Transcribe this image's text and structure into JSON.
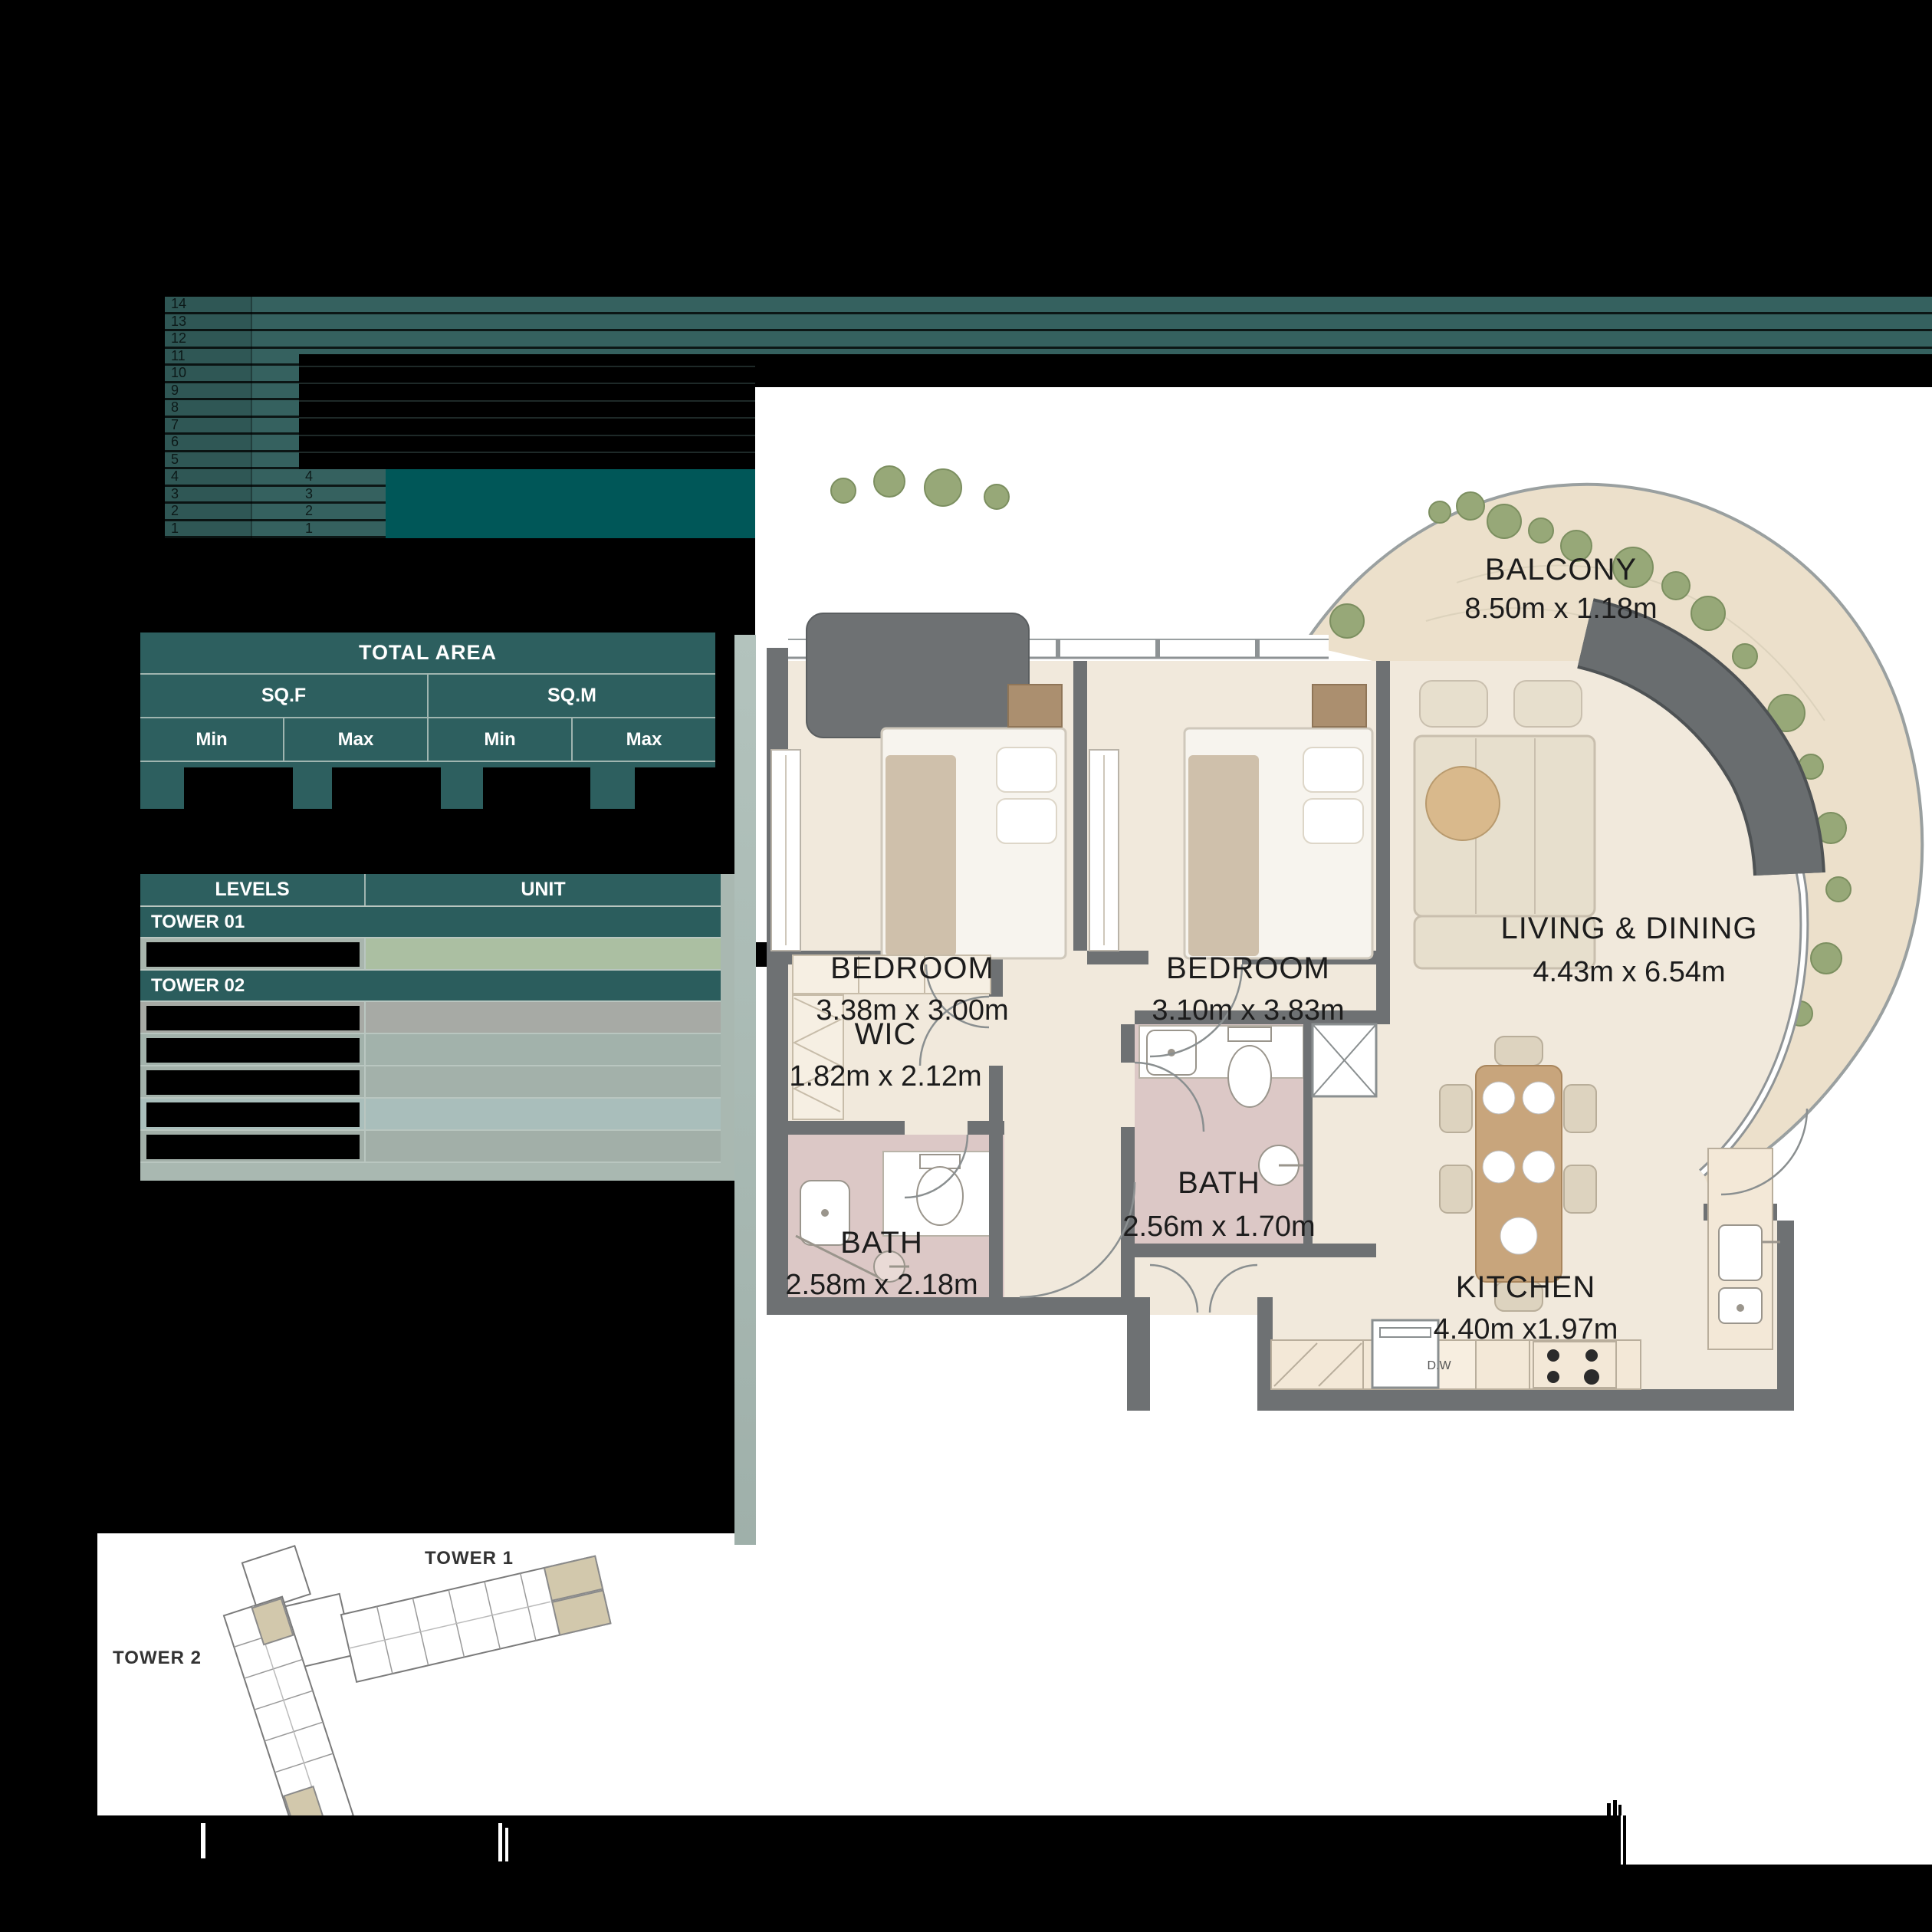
{
  "palette": {
    "teal_band": "#35615f",
    "teal_block": "#005758",
    "teal_table": "#2d5f5f",
    "sage_strip": "#a9b8b1",
    "unit_green": "#abbfa2",
    "plan_floor": "#f1e9dc",
    "plan_bath_pink": "#dcc8c6",
    "plan_wall_gray": "#6e7173",
    "balcony_beige": "#ece0cb",
    "plant_green": "#97a878",
    "highlight_tan": "#d2c8ac"
  },
  "chart": {
    "tower1_levels": [
      "14",
      "13",
      "12",
      "11",
      "10",
      "9",
      "8",
      "7",
      "6",
      "5",
      "4",
      "3",
      "2",
      "1"
    ],
    "tower2_levels": [
      "4",
      "3",
      "2",
      "1"
    ]
  },
  "area_table": {
    "title": "TOTAL AREA",
    "col_groups": [
      "SQ.F",
      "SQ.M"
    ],
    "sub_headers": [
      "Min",
      "Max",
      "Min",
      "Max"
    ]
  },
  "levels_table": {
    "col1": "LEVELS",
    "col2": "UNIT",
    "tower1_label": "TOWER 01",
    "tower2_label": "TOWER 02"
  },
  "floor_plan": {
    "rooms": [
      {
        "name": "BALCONY",
        "dims": "8.50m x 1.18m"
      },
      {
        "name": "BEDROOM",
        "dims": "3.38m x 3.00m"
      },
      {
        "name": "BEDROOM",
        "dims": "3.10m x 3.83m"
      },
      {
        "name": "WIC",
        "dims": "1.82m x 2.12m"
      },
      {
        "name": "BATH",
        "dims": "2.58m x 2.18m"
      },
      {
        "name": "BATH",
        "dims": "2.56m x 1.70m"
      },
      {
        "name": "LIVING & DINING",
        "dims": "4.43m x 6.54m"
      },
      {
        "name": "KITCHEN",
        "dims": "4.40m x1.97m"
      }
    ],
    "appliance_labels": {
      "dishwasher": "D.W"
    }
  },
  "key_plan": {
    "tower1_label": "TOWER 1",
    "tower2_label": "TOWER 2"
  }
}
